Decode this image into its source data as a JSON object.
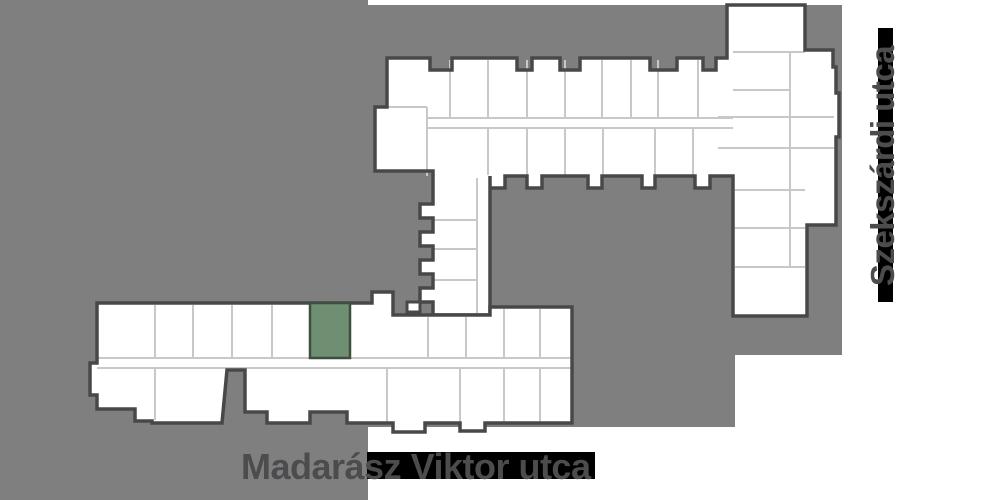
{
  "map": {
    "streets": [
      {
        "name": "Madarász Viktor utca",
        "orientation": "horizontal"
      },
      {
        "name": "Szekszárdi utca",
        "orientation": "vertical"
      }
    ],
    "highlighted_unit": {
      "fill": "#6e8f71",
      "border": "#3e4e40"
    },
    "colors": {
      "ground": "#7f7f7f",
      "wall": "#48484a",
      "divider": "#c8c8c8",
      "unit_fill": "#ffffff",
      "street_band": "#000000",
      "label": "#4c4c4e"
    }
  }
}
